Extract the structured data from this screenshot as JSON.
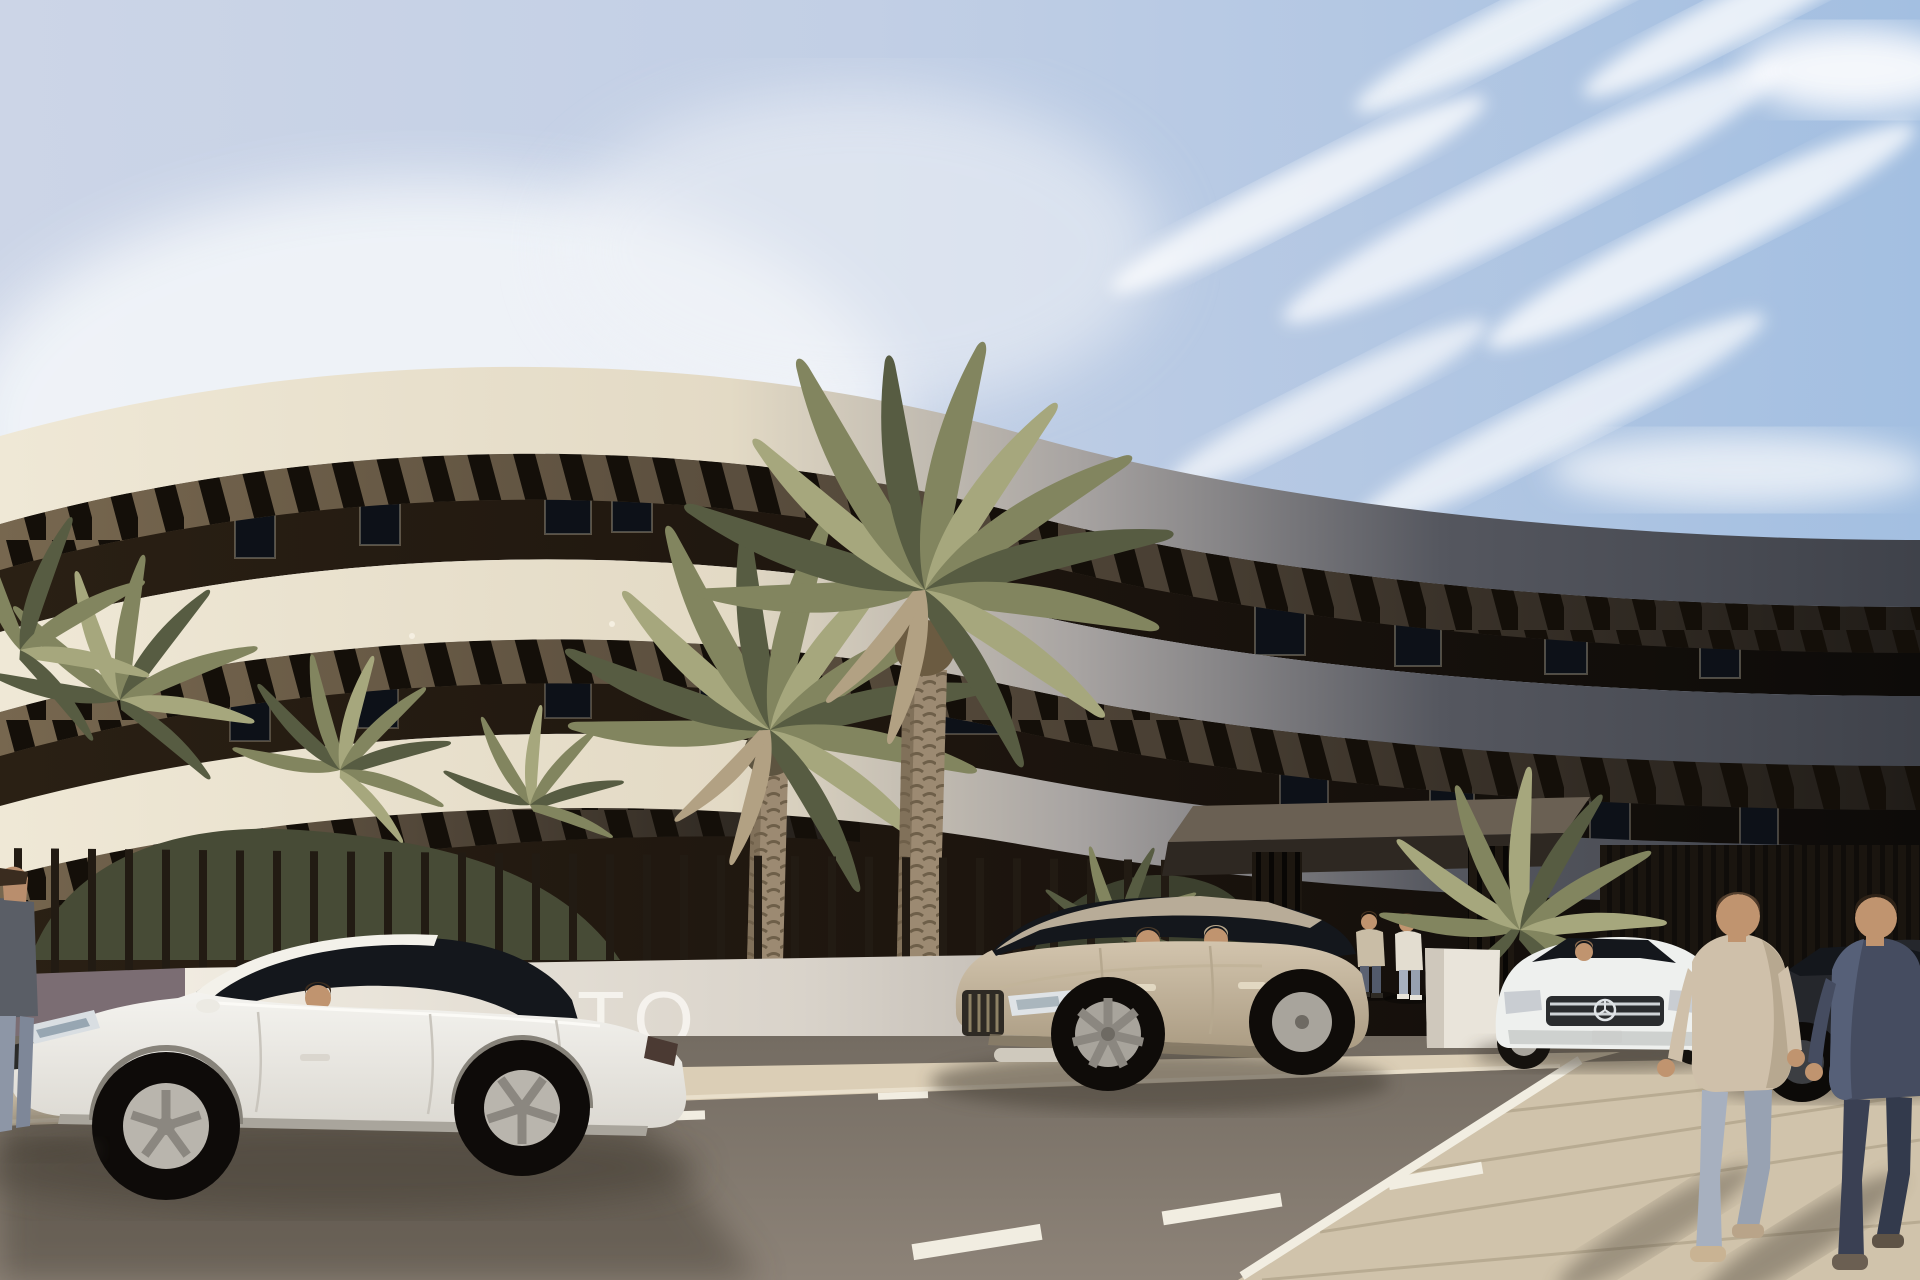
{
  "scene": {
    "kind": "architectural exterior rendering",
    "description": "Curved modern white apartment building with dark louvered terrace bands, palm trees, slatted entrance fence, parked cars and pedestrians on a sunny street",
    "sky": "blue sky with wispy clouds"
  },
  "sign": {
    "text": "TO"
  },
  "objects": {
    "building": "curved cream apartment block with dark recessed terraces and pergola louvers",
    "entrance_canopy": "dark flat entrance canopy on slatted columns",
    "fence": "low wall with thin vertical metal bars",
    "sign_wall": "sunlit white wall with partial project-name lettering",
    "white_sedan": "white sports sedan with driver, parked foreground left",
    "champagne_suv": "champagne SUV with two occupants, parked center",
    "white_mercedes": "white Mercedes-style sedan with driver, parked right",
    "dark_sedan": "dark sedan parked far right",
    "walking_men": "two men walking away on right sidewalk",
    "entrance_people": "two people talking under entrance canopy",
    "left_pedestrian": "partially visible pedestrian at left edge",
    "palms": "tall date palms and low fan palms",
    "road": "asphalt street with dashed white lane markings",
    "sidewalk": "paved sidewalks along street"
  },
  "colors": {
    "sky-left": "#ccd5e7",
    "sky-right": "#a3bfe1",
    "cloud": "#f8fafc",
    "band-cream": "#efe8d6",
    "band-cream-2": "#e3dac5",
    "band-gray": "#55575f",
    "band-gray-2": "#3f424a",
    "recess-dark": "#1d150e",
    "louver-bar": "#140f09",
    "soffit-warm": "#77674f",
    "wall-white": "#f0ebe0",
    "wall-gray": "#b5afa8",
    "stone": "#7b6d73",
    "fence-bar": "#221b13",
    "fence-right": "#17130e",
    "sign-text": "#f6f4ef",
    "road-near": "#8d8378",
    "road-far": "#746c62",
    "sidewalk": "#dbceb6",
    "sidewalk-right": "#d0c3ab",
    "joint": "#b3a68c",
    "marking": "#f1ede1",
    "shadow": "#4a4238",
    "palm": "#82855f",
    "palm-dark": "#575c42",
    "palm-light": "#a6a77d",
    "palm-tan": "#b2a183",
    "trunk": "#9c8a72",
    "trunk-dark": "#6f604b",
    "car-white": "#f4f3ef",
    "car-white-2": "#dcd9d2",
    "glass": "#14171c",
    "suv": "#d2c4ad",
    "suv-2": "#ab9c83",
    "merc": "#eef0ee",
    "dark-car": "#25272c",
    "skin": "#c0946f",
    "hair": "#463321",
    "tan-shirt": "#cfc0aa",
    "jeans-light": "#a7b0bf",
    "navy-shirt": "#454c60",
    "jeans-dark": "#3a4053"
  }
}
